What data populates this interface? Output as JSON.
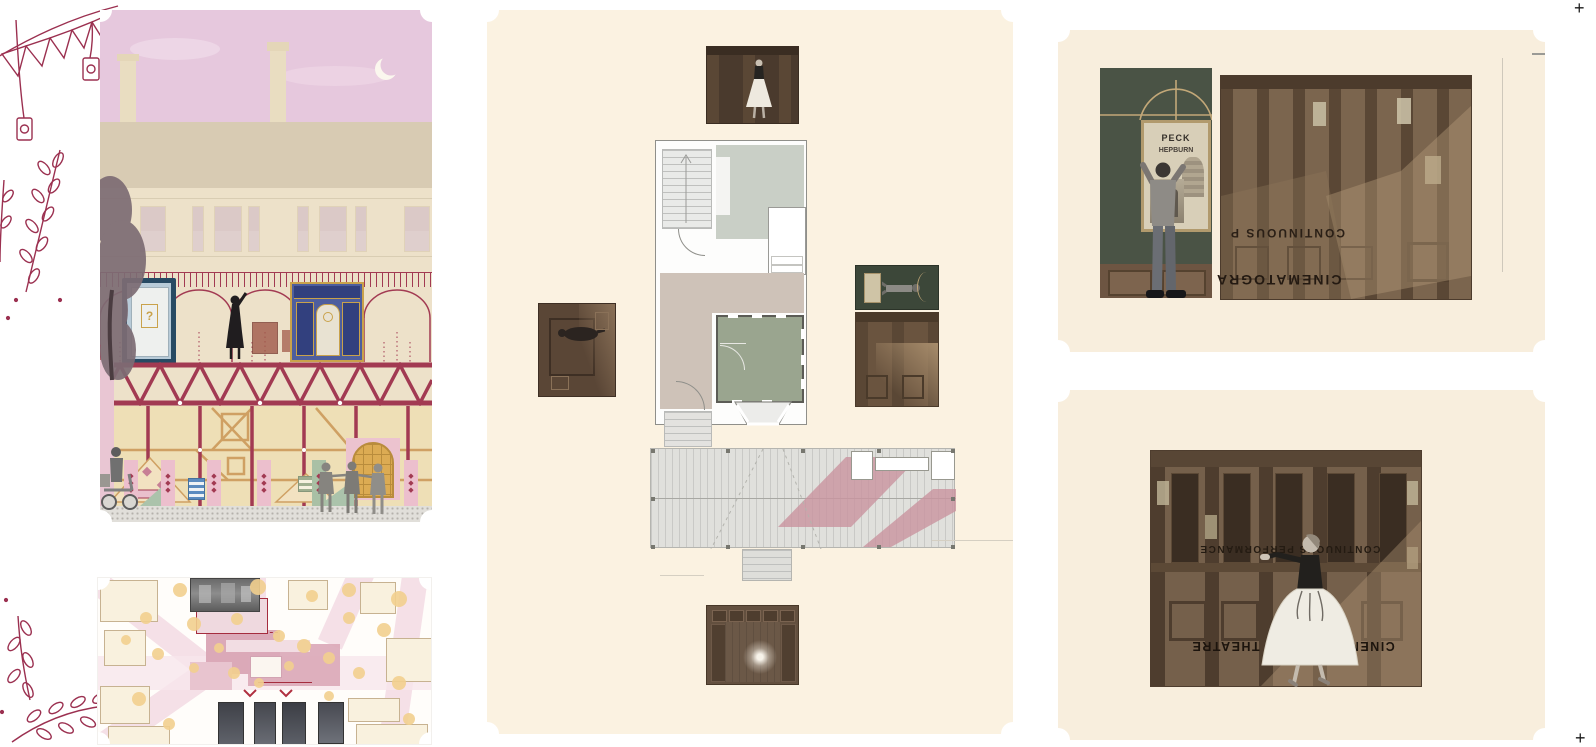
{
  "board": {
    "crop_mark_top_right": "+",
    "crop_mark_bottom_right": "+"
  },
  "decor": {
    "line_color": "#9b3050",
    "diamond_glyph": "◆"
  },
  "elevation": {
    "mystery_door_label": "?",
    "sky_color": "#e6c8dd",
    "roof_color": "#d8cbb3",
    "wall_color": "#ede1c9",
    "frame_red": "#a23a52",
    "timber_tan": "#cfa063",
    "lower_wall": "#eedfb6",
    "windows": [
      [
        40,
        24
      ],
      [
        92,
        10
      ],
      [
        114,
        26
      ],
      [
        148,
        10
      ],
      [
        197,
        10
      ],
      [
        219,
        26
      ],
      [
        255,
        10
      ],
      [
        304,
        24
      ]
    ],
    "pillars": [
      {
        "x": 24,
        "c": "#ecbfcd"
      },
      {
        "x": 61,
        "c": "#ecbfcd"
      },
      {
        "x": 107,
        "c": "#ecbfcd"
      },
      {
        "x": 157,
        "c": "#ecbfcd"
      },
      {
        "x": 212,
        "c": "#a9c0a5"
      },
      {
        "x": 304,
        "c": "#ecbfcd"
      }
    ]
  },
  "site_plan": {
    "road_color": "#f5e0e7",
    "building_fill": "#f9f1de",
    "building_outline": "#c7b291",
    "theatre_pink": "#dba9b8",
    "tree_color": "#f2cf8e",
    "trees": [
      [
        82,
        12,
        7
      ],
      [
        160,
        9,
        8
      ],
      [
        214,
        18,
        6
      ],
      [
        251,
        12,
        7
      ],
      [
        301,
        21,
        8
      ],
      [
        48,
        40,
        6
      ],
      [
        96,
        46,
        7
      ],
      [
        139,
        41,
        6
      ],
      [
        28,
        62,
        5
      ],
      [
        251,
        40,
        6
      ],
      [
        286,
        52,
        7
      ],
      [
        60,
        76,
        6
      ],
      [
        181,
        58,
        6
      ],
      [
        206,
        68,
        7
      ],
      [
        231,
        80,
        6
      ],
      [
        136,
        95,
        6
      ],
      [
        96,
        90,
        5
      ],
      [
        261,
        95,
        6
      ],
      [
        301,
        105,
        7
      ],
      [
        41,
        121,
        7
      ],
      [
        161,
        105,
        5
      ],
      [
        311,
        141,
        6
      ],
      [
        71,
        146,
        6
      ],
      [
        231,
        118,
        5
      ],
      [
        121,
        70,
        5
      ],
      [
        191,
        88,
        5
      ]
    ]
  },
  "floor_plan": {
    "panel_color": "#fbf2e1",
    "sage_room": "#9aa58f",
    "taupe_hall": "#cec2b8",
    "bedroom_gray": "#c9cfc6",
    "deck_color": "#e0e0dc",
    "shadow_pink": "#c9939f",
    "deck_posts": [
      [
        0,
        0
      ],
      [
        75,
        0
      ],
      [
        150,
        0
      ],
      [
        226,
        0
      ],
      [
        300,
        0
      ],
      [
        0,
        96
      ],
      [
        75,
        96
      ],
      [
        150,
        96
      ],
      [
        226,
        96
      ],
      [
        300,
        96
      ],
      [
        0,
        48
      ],
      [
        300,
        48
      ]
    ]
  },
  "poster_panel": {
    "panel_color": "#f8eedd",
    "wall_green": "#4a5345",
    "gold": "#c3a878",
    "wainscot": "#6d5542",
    "poster_name_1": "PECK",
    "poster_name_2": "HEPBURN",
    "montage_text_1": "CONTINUOUS P",
    "montage_text_2": "CINEMATOGRA"
  },
  "dancer_panel": {
    "panel_color": "#f8eedd",
    "montage_text_1": "CONTINUOUS PERFORMANCE",
    "montage_text_2": "CINEMATOGRAPH THEATRE"
  }
}
